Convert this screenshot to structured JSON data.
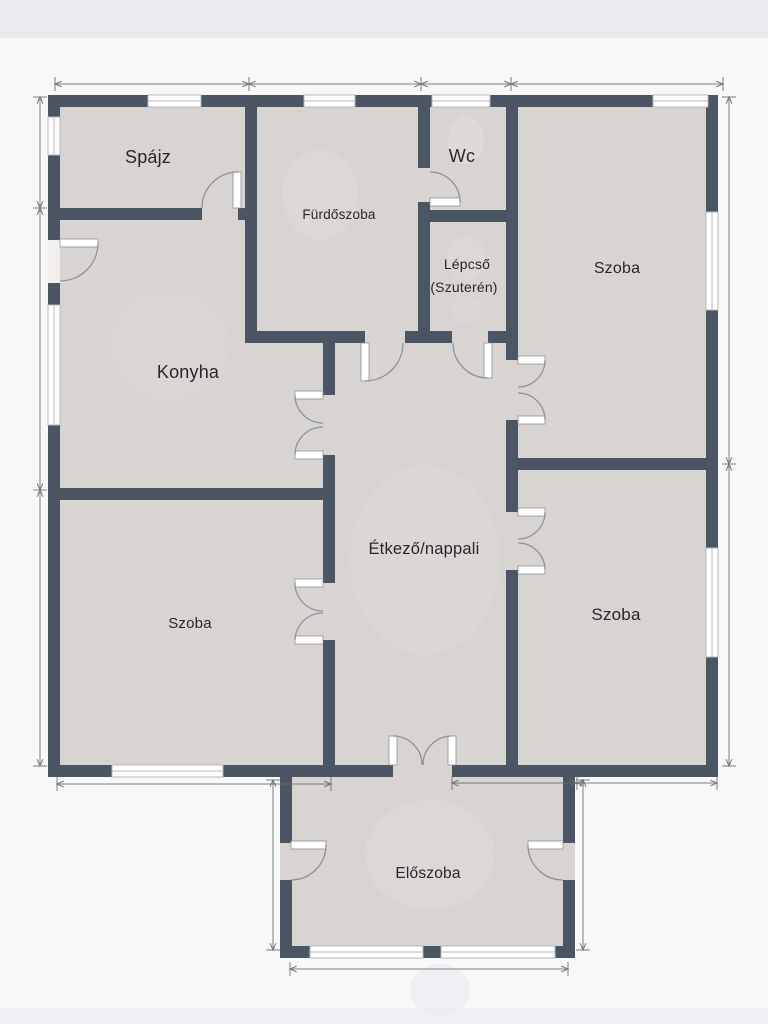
{
  "plan": {
    "type": "floor-plan",
    "language": "hu"
  },
  "rooms": [
    {
      "id": "spajz",
      "label": "Spájz"
    },
    {
      "id": "furdoszoba",
      "label": "Fürdőszoba"
    },
    {
      "id": "wc",
      "label": "Wc"
    },
    {
      "id": "lepcso",
      "label": "Lépcső",
      "label2": "(Szuterén)"
    },
    {
      "id": "szoba-felso-jobb",
      "label": "Szoba"
    },
    {
      "id": "konyha",
      "label": "Konyha"
    },
    {
      "id": "etkezo-nappali",
      "label": "Étkező/nappali"
    },
    {
      "id": "szoba-also-bal",
      "label": "Szoba"
    },
    {
      "id": "szoba-also-jobb",
      "label": "Szoba"
    },
    {
      "id": "eloszoba",
      "label": "Előszoba"
    }
  ],
  "colors": {
    "background": "#f7f8f8",
    "top_band": "#e8eaed",
    "bottom_band": "#eef0f4",
    "floor": "#d8d4d1",
    "wall": "#4b5563",
    "window": "#ffffff",
    "window_frame": "#b4b8bd",
    "threshold": "#f1efed",
    "door": "#8e9297",
    "dimension": "#66696e",
    "label": "#26282b"
  }
}
